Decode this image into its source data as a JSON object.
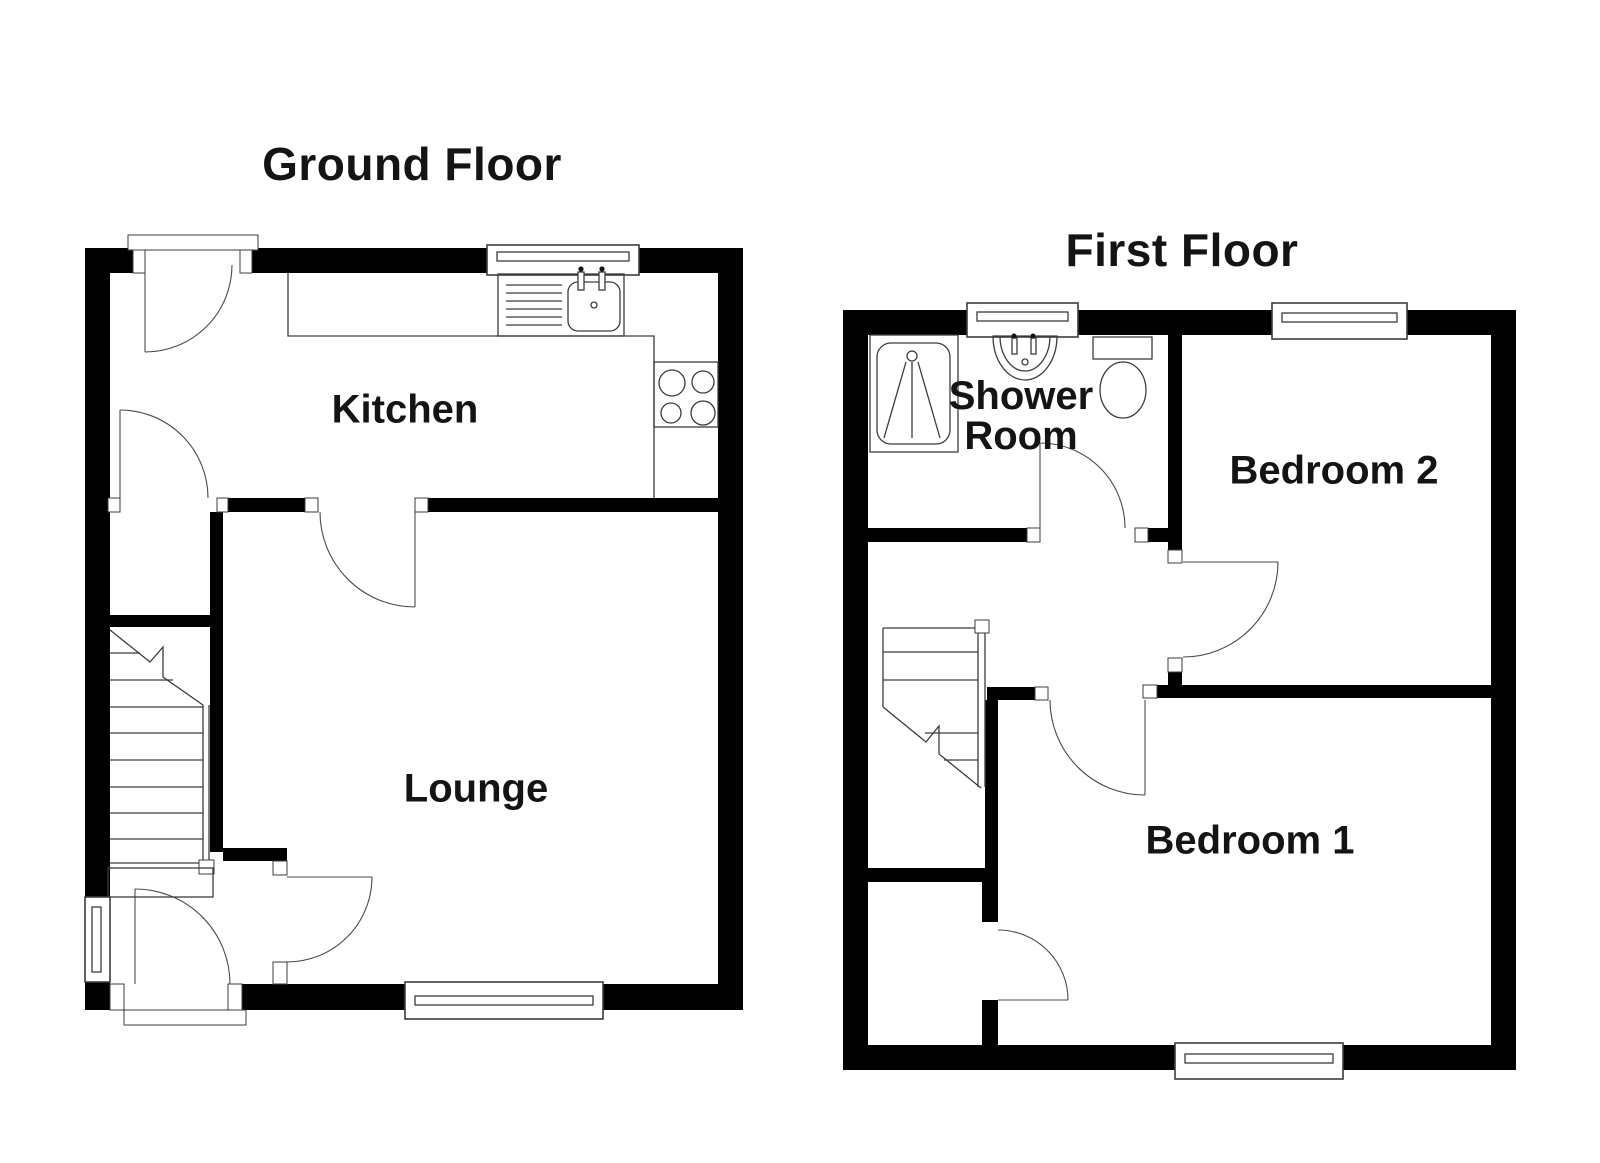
{
  "page": {
    "background": "#ffffff",
    "wall_color": "#000000",
    "line_color": "#3c3c3c",
    "text_color": "#141414"
  },
  "floors": {
    "ground": {
      "title": "Ground Floor",
      "rooms": {
        "kitchen": {
          "label": "Kitchen"
        },
        "lounge": {
          "label": "Lounge"
        }
      }
    },
    "first": {
      "title": "First Floor",
      "rooms": {
        "shower_room": {
          "label": "Shower Room",
          "line1": "Shower",
          "line2": "Room"
        },
        "bedroom2": {
          "label": "Bedroom 2"
        },
        "bedroom1": {
          "label": "Bedroom 1"
        }
      }
    }
  },
  "icons": [
    "front-door-icon",
    "entrance-door-icon",
    "internal-door-icon",
    "window-icon",
    "staircase-icon",
    "kitchen-sink-icon",
    "hob-icon",
    "shower-tray-icon",
    "wash-basin-icon",
    "toilet-icon"
  ]
}
